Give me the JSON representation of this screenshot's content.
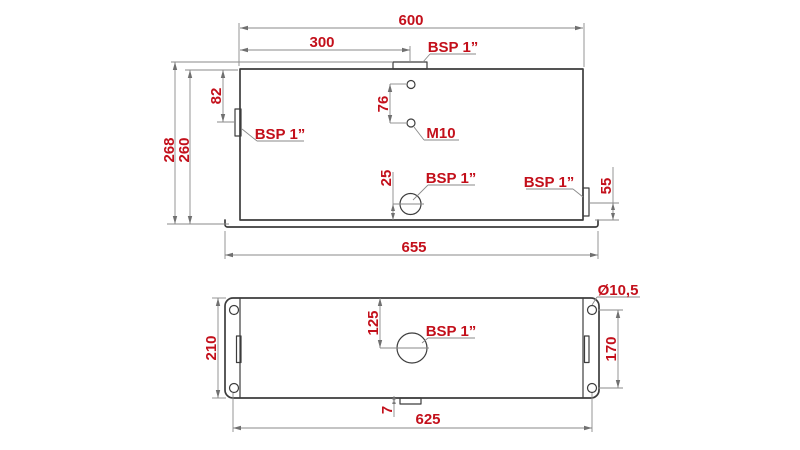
{
  "front_view": {
    "dims": {
      "top_width": "600",
      "filler_offset": "300",
      "total_height": "268",
      "body_height": "260",
      "side_port_offset": "82",
      "m10_hole_spacing": "76",
      "drain_port_height": "25",
      "return_port_height": "55",
      "base_width": "655"
    },
    "labels": {
      "filler_port": "BSP 1”",
      "side_port": "BSP 1”",
      "m10_holes": "M10",
      "drain_port": "BSP 1”",
      "return_port": "BSP 1”"
    }
  },
  "bottom_view": {
    "dims": {
      "depth": "210",
      "port_offset": "125",
      "mount_hole_spacing": "170",
      "tab_offset": "7",
      "mount_hole_span": "625"
    },
    "labels": {
      "suction_port": "BSP 1”",
      "mount_hole_diameter": "Ø10,5"
    }
  },
  "colors": {
    "dim_text": "#c3101b",
    "outline": "#3d3d3d",
    "dim_line": "#8a8a8a",
    "arrow": "#707070",
    "background": "#ffffff"
  }
}
